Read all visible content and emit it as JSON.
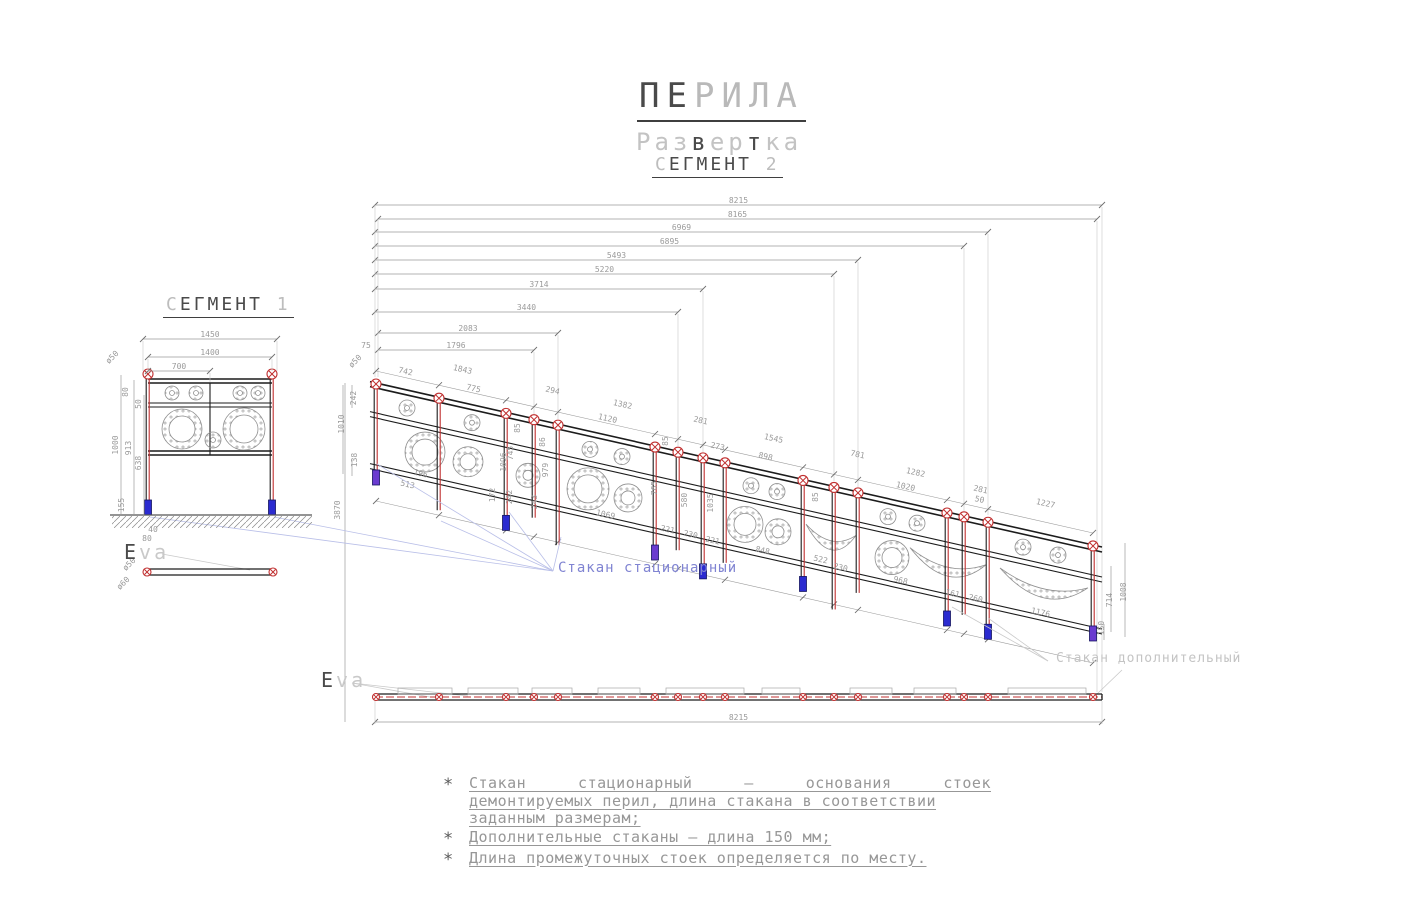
{
  "title": {
    "line1": "ПЕРИЛА",
    "line2": "Развертка",
    "line3": "СЕГМЕНТ 2"
  },
  "segment1": {
    "heading": "СЕГМЕНТ 1",
    "view_label": "Eva",
    "post_diameter_note": "ø50"
  },
  "segment2": {
    "view_label": "Eva",
    "label_cup_stationary": "Стакан стационарный",
    "label_cup_additional": "Стакан дополнительный"
  },
  "notes": {
    "bullet": "*",
    "items": [
      {
        "lines": [
          "Стакан стационарный – основания стоек",
          "демонтируемых перил, длина стакана в соответствии",
          "заданным размерам;"
        ]
      },
      {
        "lines": [
          "Дополнительные стаканы – длина 150 мм;"
        ]
      },
      {
        "lines": [
          "Длина промежуточных стоек определяется по месту."
        ]
      }
    ]
  },
  "colors": {
    "black": "#1c1c1c",
    "dim": "#9a9a9a",
    "dimDark": "#6f6f6f",
    "red": "#c03030",
    "blue_cup": "#2b2bd0",
    "purple_cup": "#6a3bd0",
    "cup_stroke": "#151560",
    "leader": "#b9bfe8",
    "hatch": "#8a8a8a"
  },
  "drawing": {
    "seg2": {
      "rail": {
        "x0": 376,
        "y0": 383,
        "slope": 0.2259,
        "xStart": 370,
        "xEnd": 1102,
        "offsets": [
          0,
          5,
          30,
          35,
          82,
          87
        ]
      },
      "posts": [
        {
          "x": 376,
          "depth": 14,
          "cup": "purple"
        },
        {
          "x": 439,
          "depth": 26,
          "cup": null
        },
        {
          "x": 506,
          "depth": 30,
          "cup": "blue"
        },
        {
          "x": 534,
          "depth": 12,
          "cup": null
        },
        {
          "x": 558,
          "depth": 34,
          "cup": null
        },
        {
          "x": 655,
          "depth": 26,
          "cup": "purple"
        },
        {
          "x": 678,
          "depth": 12,
          "cup": null
        },
        {
          "x": 703,
          "depth": 34,
          "cup": "blue"
        },
        {
          "x": 725,
          "depth": 14,
          "cup": null
        },
        {
          "x": 803,
          "depth": 24,
          "cup": "blue"
        },
        {
          "x": 834,
          "depth": 36,
          "cup": null
        },
        {
          "x": 858,
          "depth": 14,
          "cup": null
        },
        {
          "x": 947,
          "depth": 26,
          "cup": "blue"
        },
        {
          "x": 964,
          "depth": 12,
          "cup": null
        },
        {
          "x": 988,
          "depth": 30,
          "cup": "blue"
        },
        {
          "x": 1093,
          "depth": 8,
          "cup": "purple"
        }
      ],
      "chain": [
        {
          "v": "8215",
          "y": 205,
          "x1": 375,
          "x2": 1102,
          "ext": 692
        },
        {
          "v": "8165",
          "y": 219,
          "x1": 378,
          "x2": 1097,
          "ext": 692
        },
        {
          "v": "6969",
          "y": 232,
          "x1": 375,
          "x2": 988,
          "ext": 515
        },
        {
          "v": "6895",
          "y": 246,
          "x1": 375,
          "x2": 964,
          "ext": 511
        },
        {
          "v": "5493",
          "y": 260,
          "x1": 375,
          "x2": 858,
          "ext": 487
        },
        {
          "v": "5220",
          "y": 274,
          "x1": 375,
          "x2": 834,
          "ext": 481
        },
        {
          "v": "3714",
          "y": 289,
          "x1": 375,
          "x2": 703,
          "ext": 452
        },
        {
          "v": "3440",
          "y": 312,
          "x1": 375,
          "x2": 678,
          "ext": 446
        },
        {
          "v": "2083",
          "y": 333,
          "x1": 378,
          "x2": 558,
          "ext": 419
        },
        {
          "v": "1796",
          "y": 350,
          "x1": 378,
          "x2": 534,
          "ext": 414
        }
      ],
      "dims_slant": [
        {
          "v": "742",
          "x": 405,
          "y": 374
        },
        {
          "v": "1843",
          "x": 462,
          "y": 372
        },
        {
          "v": "775",
          "x": 473,
          "y": 391
        },
        {
          "v": "294",
          "x": 552,
          "y": 393
        },
        {
          "v": "1382",
          "x": 622,
          "y": 407
        },
        {
          "v": "1120",
          "x": 607,
          "y": 421
        },
        {
          "v": "281",
          "x": 700,
          "y": 423
        },
        {
          "v": "273",
          "x": 717,
          "y": 449
        },
        {
          "v": "1545",
          "x": 773,
          "y": 441
        },
        {
          "v": "898",
          "x": 765,
          "y": 459
        },
        {
          "v": "781",
          "x": 857,
          "y": 457
        },
        {
          "v": "1282",
          "x": 915,
          "y": 475
        },
        {
          "v": "1020",
          "x": 905,
          "y": 489
        },
        {
          "v": "281",
          "x": 980,
          "y": 492
        },
        {
          "v": "50",
          "x": 979,
          "y": 502
        },
        {
          "v": "1227",
          "x": 1045,
          "y": 506
        },
        {
          "v": "513",
          "x": 407,
          "y": 487
        },
        {
          "v": "196",
          "x": 420,
          "y": 476
        },
        {
          "v": "1069",
          "x": 605,
          "y": 517
        },
        {
          "v": "221",
          "x": 667,
          "y": 532
        },
        {
          "v": "230",
          "x": 690,
          "y": 537
        },
        {
          "v": "221",
          "x": 712,
          "y": 543
        },
        {
          "v": "848",
          "x": 762,
          "y": 553
        },
        {
          "v": "522",
          "x": 820,
          "y": 562
        },
        {
          "v": "230",
          "x": 840,
          "y": 570
        },
        {
          "v": "968",
          "x": 900,
          "y": 583
        },
        {
          "v": "161",
          "x": 952,
          "y": 596
        },
        {
          "v": "260",
          "x": 975,
          "y": 601
        },
        {
          "v": "1176",
          "x": 1040,
          "y": 615
        }
      ],
      "dims_vert": [
        {
          "v": "242",
          "x": 356,
          "y": 398
        },
        {
          "v": "1010",
          "x": 344,
          "y": 424
        },
        {
          "v": "138",
          "x": 357,
          "y": 460
        },
        {
          "v": "3870",
          "x": 340,
          "y": 510
        },
        {
          "v": "85",
          "x": 520,
          "y": 428
        },
        {
          "v": "86",
          "x": 545,
          "y": 442
        },
        {
          "v": "745",
          "x": 513,
          "y": 453
        },
        {
          "v": "1096",
          "x": 506,
          "y": 462
        },
        {
          "v": "979",
          "x": 548,
          "y": 470
        },
        {
          "v": "85",
          "x": 668,
          "y": 441
        },
        {
          "v": "765",
          "x": 657,
          "y": 488
        },
        {
          "v": "580",
          "x": 687,
          "y": 500
        },
        {
          "v": "1035",
          "x": 713,
          "y": 503
        },
        {
          "v": "172",
          "x": 495,
          "y": 495
        },
        {
          "v": "242",
          "x": 512,
          "y": 497
        },
        {
          "v": "243",
          "x": 537,
          "y": 502
        },
        {
          "v": "85",
          "x": 818,
          "y": 497
        },
        {
          "v": "714",
          "x": 1112,
          "y": 600
        },
        {
          "v": "1008",
          "x": 1126,
          "y": 592
        },
        {
          "v": "150",
          "x": 1104,
          "y": 628
        }
      ],
      "dims_misc": [
        {
          "v": "75",
          "x": 366,
          "y": 348,
          "a": 0
        },
        {
          "v": "ø50",
          "x": 357,
          "y": 363,
          "a": -45
        }
      ],
      "vlines": [
        {
          "x": 352,
          "y1": 385,
          "y2": 408
        },
        {
          "x": 343,
          "y1": 385,
          "y2": 474
        },
        {
          "x": 352,
          "y1": 460,
          "y2": 476
        },
        {
          "x": 345,
          "y1": 383,
          "y2": 722
        },
        {
          "x": 1104,
          "y1": 624,
          "y2": 640
        },
        {
          "x": 1111,
          "y1": 566,
          "y2": 632
        },
        {
          "x": 1125,
          "y1": 543,
          "y2": 637
        }
      ],
      "slant_chains": [
        {
          "off": -12
        },
        {
          "off": 118
        }
      ],
      "ornaments_lower": [
        {
          "t": "spiral",
          "x": 425,
          "r": 20
        },
        {
          "t": "spiral",
          "x": 468,
          "r": 15
        },
        {
          "t": "spiral",
          "x": 528,
          "r": 12
        },
        {
          "t": "spiral",
          "x": 588,
          "r": 21
        },
        {
          "t": "spiral",
          "x": 628,
          "r": 14
        },
        {
          "t": "spiral",
          "x": 745,
          "r": 18
        },
        {
          "t": "spiral",
          "x": 778,
          "r": 13
        },
        {
          "t": "arch",
          "x1": 806,
          "x2": 856
        },
        {
          "t": "spiral",
          "x": 892,
          "r": 17
        },
        {
          "t": "arch",
          "x1": 910,
          "x2": 986
        },
        {
          "t": "arch",
          "x1": 1000,
          "x2": 1088
        }
      ],
      "ornaments_upper_x": [
        407,
        472,
        590,
        622,
        751,
        777,
        888,
        917,
        1023,
        1058
      ],
      "leader_origin": [
        553,
        571
      ],
      "leader_targets": [
        [
          150,
          517
        ],
        [
          274,
          517
        ],
        [
          377,
          464
        ],
        [
          441,
          521
        ],
        [
          509,
          512
        ],
        [
          561,
          537
        ]
      ],
      "leaders_gray": [
        [
          1048,
          661,
          988,
          618
        ],
        [
          1048,
          661,
          952,
          607
        ],
        [
          1122,
          670,
          1097,
          694
        ],
        [
          352,
          683,
          430,
          697
        ],
        [
          352,
          683,
          468,
          696
        ],
        [
          162,
          554,
          250,
          570
        ]
      ],
      "bar": {
        "y": 697,
        "x1": 375,
        "x2": 1102,
        "dim": {
          "v": "8215",
          "y": 722
        },
        "rects": [
          [
            398,
            452
          ],
          [
            468,
            518
          ],
          [
            532,
            572
          ],
          [
            598,
            640
          ],
          [
            666,
            744
          ],
          [
            762,
            800
          ],
          [
            850,
            892
          ],
          [
            914,
            956
          ],
          [
            1008,
            1086
          ]
        ]
      }
    },
    "seg1": {
      "frame": {
        "x1": 148,
        "x2": 272,
        "railY": [
          379,
          383,
          403,
          407,
          451,
          455
        ],
        "midX": 210,
        "postTop": 374,
        "ground": 515,
        "hatch": [
          112,
          516,
          200,
          12
        ]
      },
      "cups": [
        148,
        272
      ],
      "ornaments": [
        {
          "x": 172,
          "y": 393,
          "r": 7
        },
        {
          "x": 196,
          "y": 393,
          "r": 7
        },
        {
          "x": 240,
          "y": 393,
          "r": 7
        },
        {
          "x": 258,
          "y": 393,
          "r": 7
        },
        {
          "x": 182,
          "y": 429,
          "r": 20
        },
        {
          "x": 244,
          "y": 429,
          "r": 21
        },
        {
          "x": 213,
          "y": 440,
          "r": 8
        }
      ],
      "chain": [
        {
          "v": "1450",
          "y": 339,
          "x1": 143,
          "x2": 277
        },
        {
          "v": "1400",
          "y": 357,
          "x1": 148,
          "x2": 272
        },
        {
          "v": "700",
          "y": 371,
          "x1": 148,
          "x2": 210
        }
      ],
      "vdims": [
        {
          "v": "1000",
          "x": 118,
          "y": 445
        },
        {
          "v": "913",
          "x": 131,
          "y": 448
        },
        {
          "v": "638",
          "x": 141,
          "y": 463
        },
        {
          "v": "50",
          "x": 141,
          "y": 404
        },
        {
          "v": "80",
          "x": 128,
          "y": 392
        }
      ],
      "vlines": [
        {
          "x": 121,
          "y1": 375,
          "y2": 515
        },
        {
          "x": 134,
          "y1": 380,
          "y2": 515
        },
        {
          "x": 144,
          "y1": 395,
          "y2": 515
        }
      ],
      "extlines": [
        {
          "x": 143,
          "y1": 341,
          "y2": 371
        },
        {
          "x": 277,
          "y1": 341,
          "y2": 371
        },
        {
          "x": 148,
          "y1": 359,
          "y2": 371
        },
        {
          "x": 272,
          "y1": 359,
          "y2": 371
        },
        {
          "x": 210,
          "y1": 373,
          "y2": 382
        }
      ],
      "cup_dims": [
        {
          "v": "155",
          "x": 124,
          "y": 505,
          "a": -90
        },
        {
          "v": "40",
          "x": 153,
          "y": 532,
          "a": 0
        },
        {
          "v": "80",
          "x": 147,
          "y": 541,
          "a": 0
        }
      ],
      "dia_note": {
        "v": "ø50",
        "x": 114,
        "y": 359,
        "a": -45
      },
      "bar": {
        "x1": 147,
        "x2": 273,
        "y": 572,
        "dims": [
          {
            "v": "ø50",
            "x": 131,
            "y": 566,
            "a": -45
          },
          {
            "v": "ø60",
            "x": 125,
            "y": 585,
            "a": -45
          }
        ]
      }
    }
  }
}
